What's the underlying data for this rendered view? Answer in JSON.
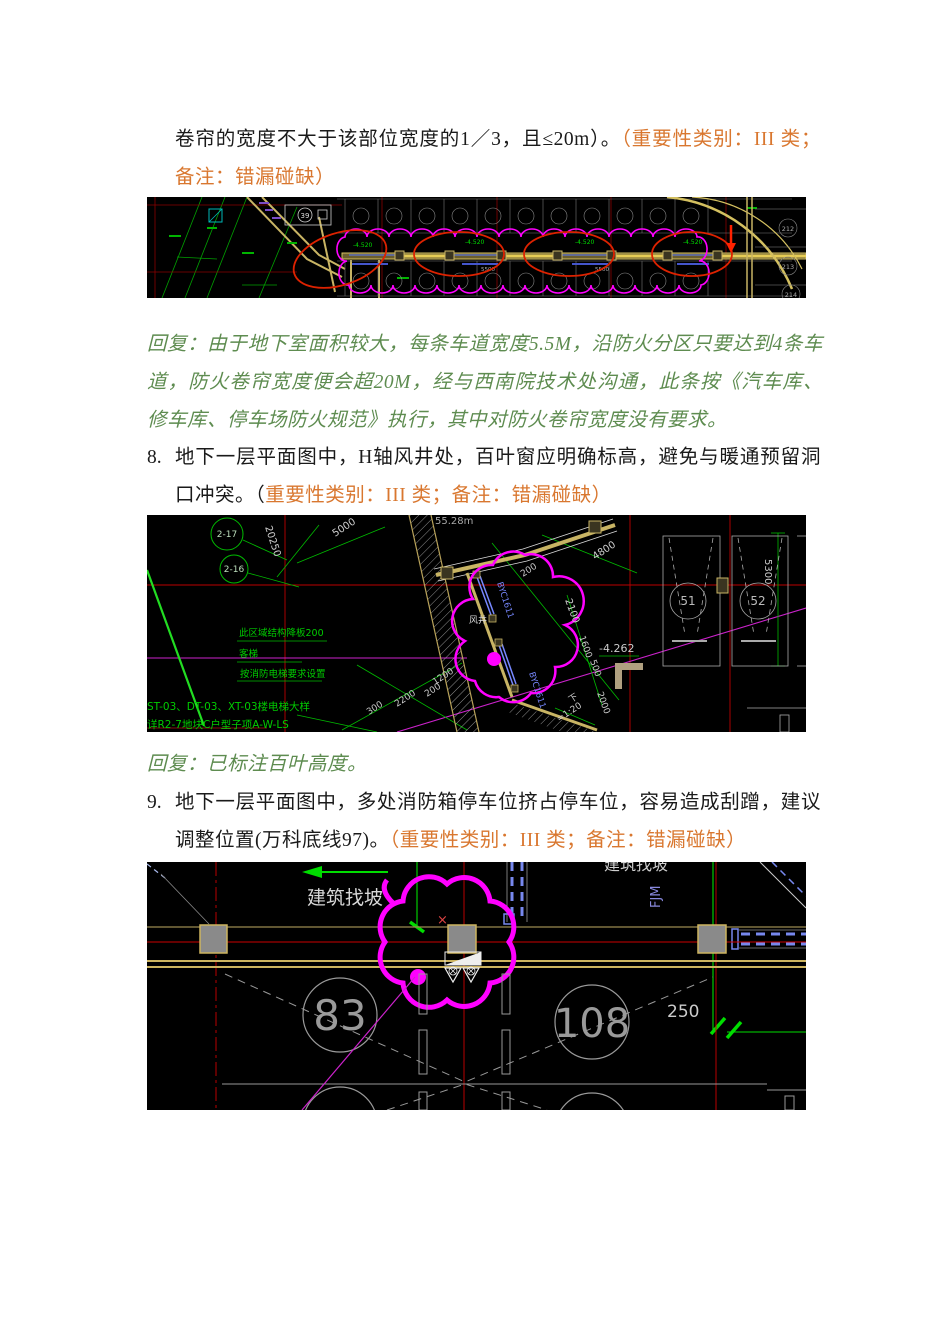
{
  "doc": {
    "item7_continuation": {
      "black_text": "卷帘的宽度不大于该部位宽度的1／3，且≤20m）。",
      "orange_text": "（重要性类别：III 类；备注：错漏碰缺）"
    },
    "reply1": "回复：由于地下室面积较大，每条车道宽度5.5M，沿防火分区只要达到4条车道，防火卷帘宽度便会超20M，经与西南院技术处沟通，此条按《汽车库、修车库、停车场防火规范》执行，其中对防火卷帘宽度没有要求。",
    "item8": {
      "number": "8.",
      "black_text": "地下一层平面图中，H轴风井处，百叶窗应明确标高，避免与暖通预留洞口冲突。（",
      "orange_text": "重要性类别：III 类；备注：错漏碰缺）"
    },
    "reply2": "回复：已标注百叶高度。",
    "item9": {
      "number": "9.",
      "black_text": "地下一层平面图中，多处消防箱停车位挤占停车位，容易造成刮蹭，建议调整位置(万科底线97)。",
      "orange_text": "（重要性类别：III 类；备注：错漏碰缺）"
    }
  },
  "colors": {
    "orange": "#D9772F",
    "reply_green": "#5E8C50",
    "cad_magenta": "#FF00FF",
    "cad_red": "#CC0000",
    "cad_green": "#00CC00",
    "cad_khaki": "#C8B464"
  },
  "cad1": {
    "legend": "39",
    "levels": [
      "-4.520",
      "-4.520",
      "-4.520",
      "-4.520"
    ],
    "dims": [
      "5500",
      "5500"
    ],
    "stalls": [
      "212",
      "213",
      "214"
    ]
  },
  "cad2": {
    "bubbles": [
      "2-17",
      "2-16"
    ],
    "area": "55.28m",
    "notes": [
      "此区域结构降板200",
      "客梯",
      "按消防电梯要求设置"
    ],
    "footnotes": [
      "ST-03、DT-03、XT-03楼电梯大样",
      "详R2-7地块C户型子项A-W-LS"
    ],
    "shaft": {
      "label1": "BYC1611",
      "label2": "BYC1611",
      "name": "风井"
    },
    "dims": {
      "d20250": "20250",
      "d5000": "5000",
      "d4800": "4800",
      "d200": "200",
      "d2100": "2100",
      "d1600": "1600",
      "d500": "500",
      "d2000": "2000",
      "d1200": "1200",
      "d300": "300",
      "d2200": "2200",
      "d200b": "200",
      "d5300": "5300"
    },
    "level": "-4.262",
    "slope_down": "下",
    "slope": "=1:20",
    "stalls": [
      "51",
      "52"
    ]
  },
  "cad3": {
    "slope_note": "建筑找坡",
    "top_cut_note": "建筑找坡",
    "duct_label": "FJM",
    "cross": "×",
    "stalls": [
      "83",
      "108"
    ],
    "dim250": "250"
  }
}
